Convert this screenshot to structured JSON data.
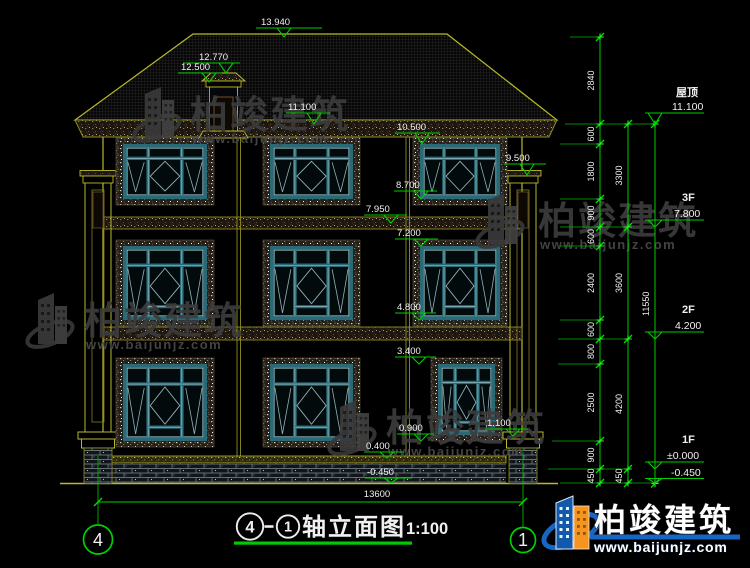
{
  "page": {
    "background": "#000000"
  },
  "drawing": {
    "title": {
      "axis_from": "4",
      "separator": "—",
      "axis_to": "1",
      "name": "轴立面图",
      "scale": "1:100"
    },
    "bottom_dimension": "13600",
    "axis_bubbles": {
      "left": "4",
      "right": "1"
    },
    "elevation_markers": {
      "ridge": "13.940",
      "chimney_top": "12.770",
      "chimney_under": "12.500",
      "eave": "11.100",
      "w3_top": "10.500",
      "pilaster_cap": "9.500",
      "w3_sill": "8.700",
      "belt_top": "7.950",
      "w2_top": "7.200",
      "w2_sill": "4.800",
      "w1_top": "3.400",
      "w1_sill": "0.900",
      "w1r_sill": "1.100",
      "plinth": "0.400",
      "ground": "-0.450"
    },
    "levels": [
      {
        "label": "屋顶",
        "value": "11.100"
      },
      {
        "label": "3F",
        "value": "7.800"
      },
      {
        "label": "2F",
        "value": "4.200"
      },
      {
        "label": "1F",
        "value": "±0.000"
      },
      {
        "label": "",
        "value": "-0.450"
      }
    ],
    "chains": {
      "inner": [
        "2840",
        "600",
        "1800",
        "900",
        "600",
        "2400",
        "600",
        "800",
        "2500",
        "900",
        "450"
      ],
      "middle": [
        "3300",
        "3600",
        "4200",
        "450"
      ],
      "outer": [
        "11550"
      ]
    }
  },
  "watermark": {
    "name": "柏竣建筑",
    "url": "www.baijunjz.com"
  },
  "colors": {
    "line_yellow": "#b9b92b",
    "dim_green": "#00cc00",
    "text_white": "#f0f0f0",
    "window_teal": "#2a6a76",
    "logo_blue": "#1059ad",
    "logo_orange": "#f5941e"
  }
}
